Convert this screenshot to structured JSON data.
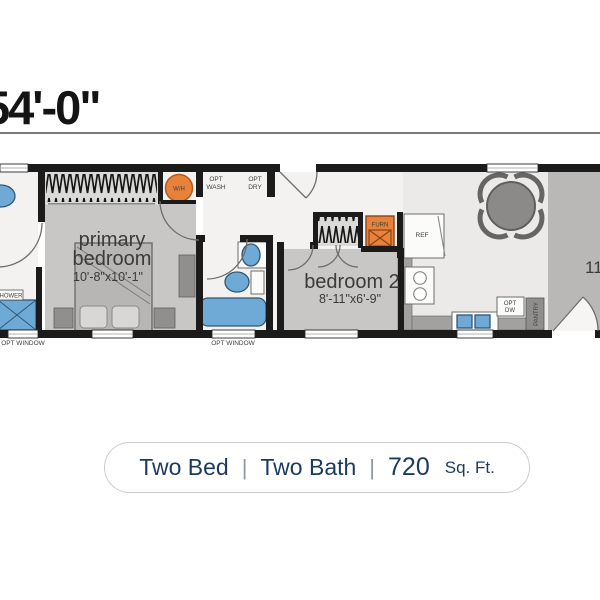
{
  "title": {
    "dimension": "54'-0\""
  },
  "rooms": {
    "primary_bedroom": {
      "name_line1": "primary",
      "name_line2": "bedroom",
      "dimensions": "10'-8\"x10'-1\""
    },
    "bedroom2": {
      "name": "bedroom 2",
      "dimensions": "8'-11\"x6'-9\""
    },
    "living": {
      "partial_dimension": "11"
    }
  },
  "labels": {
    "opt_wash_l1": "OPT",
    "opt_wash_l2": "WASH",
    "opt_dry_l1": "OPT",
    "opt_dry_l2": "DRY",
    "opt_dw_l1": "OPT",
    "opt_dw_l2": "DW",
    "pantry": "PANTRY",
    "ref": "REF",
    "water_heater": "W/H",
    "furnace": "FURN",
    "shower": "SHOWER",
    "opt_window": "OPT WINDOW"
  },
  "caption": {
    "beds": "Two Bed",
    "separator": "|",
    "baths": "Two Bath",
    "sqft_value": "720",
    "sqft_unit": "Sq. Ft."
  },
  "colors": {
    "wall": "#1b1b1b",
    "fixture_blue": "#6fa9d6",
    "appliance_orange": "#e8823a",
    "caption_text": "#1c3a5e"
  }
}
